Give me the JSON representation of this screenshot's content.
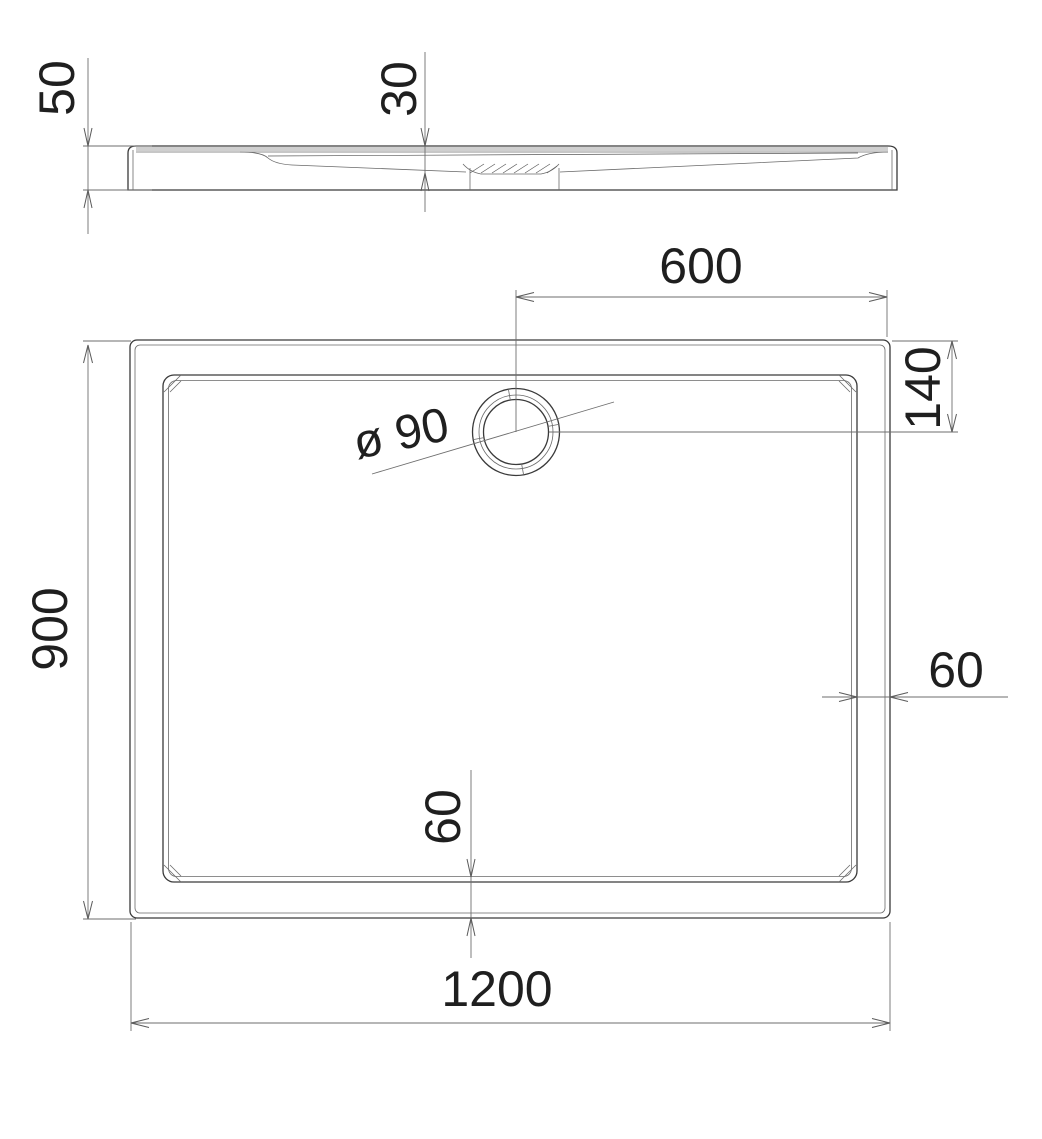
{
  "drawing": {
    "type": "technical-dimension-drawing",
    "subject": "rectangular-shower-tray",
    "background": "#ffffff",
    "colors": {
      "object_line": "#3a3a3a",
      "thin_line": "#6a6a6a",
      "dimension_line": "#6e6e6e",
      "text": "#1f1f1f",
      "rim_shade": "#cfcfcf"
    }
  },
  "dimensions": {
    "side_height": "50",
    "basin_depth": "30",
    "drain_center_from_right": "600",
    "drain_center_from_top": "140",
    "drain_diameter": "ø 90",
    "tray_width": "900",
    "rim_width_right": "60",
    "rim_width_bottom": "60",
    "tray_length": "1200"
  }
}
